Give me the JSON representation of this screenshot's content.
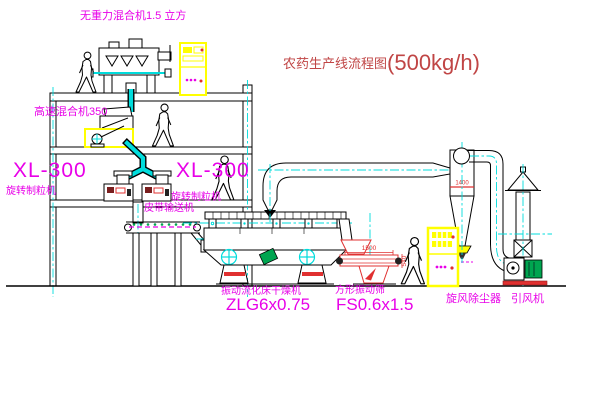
{
  "title": {
    "name": "农药生产线流程图",
    "capacity": "(500kg/h)"
  },
  "labels": {
    "gravity_mixer": "无重力混合机1.5 立方",
    "high_speed_mixer": "高速混合机350",
    "granulator_left_model": "XL-300",
    "granulator_left_name": "旋转制粒机",
    "granulator_right_model": "XL-300",
    "granulator_right_name": "旋转制粒机",
    "belt_conveyor": "皮带输送机",
    "dryer_name": "振动流化床干燥机",
    "dryer_model": "ZLG6x0.75",
    "sieve_name": "方形振动筛",
    "sieve_model": "FS0.6x1.5",
    "cyclone_name": "旋风除尘器",
    "fan_name": "引风机"
  },
  "dimensions": {
    "sieve_length": "1500",
    "sieve_height": "540",
    "cyclone_inlet": "1400"
  },
  "colors": {
    "label_magenta": "#e800e8",
    "title_red": "#c04545",
    "centerline_cyan": "#00dcdc",
    "cabinet_yellow": "#ffff00",
    "accent_red": "#e03030",
    "accent_green": "#00a550",
    "line_black": "#000000"
  }
}
